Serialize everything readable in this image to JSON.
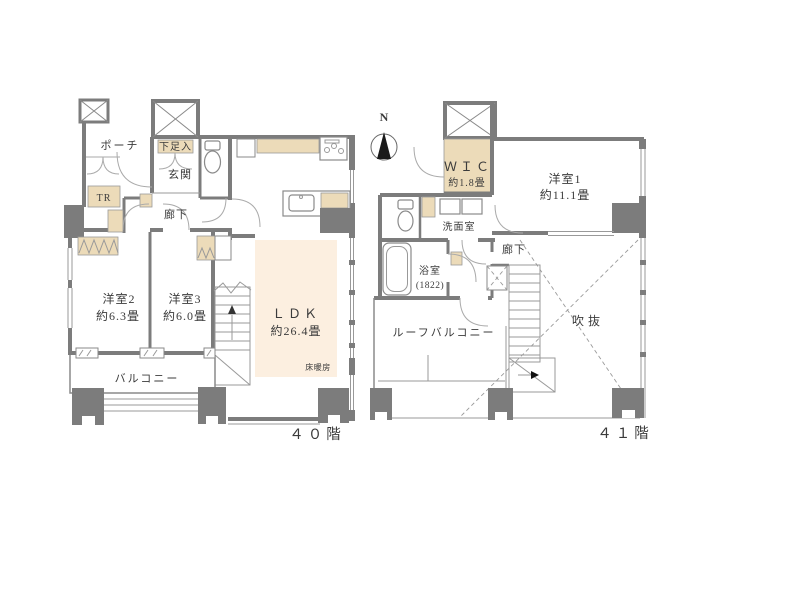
{
  "title": "apartment-floor-plan",
  "colors": {
    "wall": "#7c7c7c",
    "closet_beige": "#ecdbb9",
    "ldk_floor": "#fcefe0",
    "text": "#3b3b3b",
    "thin_line": "#999999"
  },
  "compass": {
    "north_label": "N"
  },
  "floor40": {
    "floor_label": "４０階",
    "rooms": {
      "porch": "ポーチ",
      "shoe_cabinet": "下足入",
      "entrance": "玄関",
      "trunk_room": "TR",
      "corridor": "廊下",
      "bedroom2_name": "洋室2",
      "bedroom2_size": "約6.3畳",
      "bedroom3_name": "洋室3",
      "bedroom3_size": "約6.0畳",
      "ldk_name": "ＬＤＫ",
      "ldk_size": "約26.4畳",
      "floor_heating": "床暖房",
      "balcony": "バルコニー"
    }
  },
  "floor41": {
    "floor_label": "４１階",
    "rooms": {
      "wic_name": "ＷＩＣ",
      "wic_size": "約1.8畳",
      "bedroom1_name": "洋室1",
      "bedroom1_size": "約11.1畳",
      "washroom": "洗面室",
      "bathroom_name": "浴室",
      "bathroom_size": "(1822)",
      "corridor": "廊下",
      "roof_balcony": "ルーフバルコニー",
      "void": "吹抜"
    }
  }
}
